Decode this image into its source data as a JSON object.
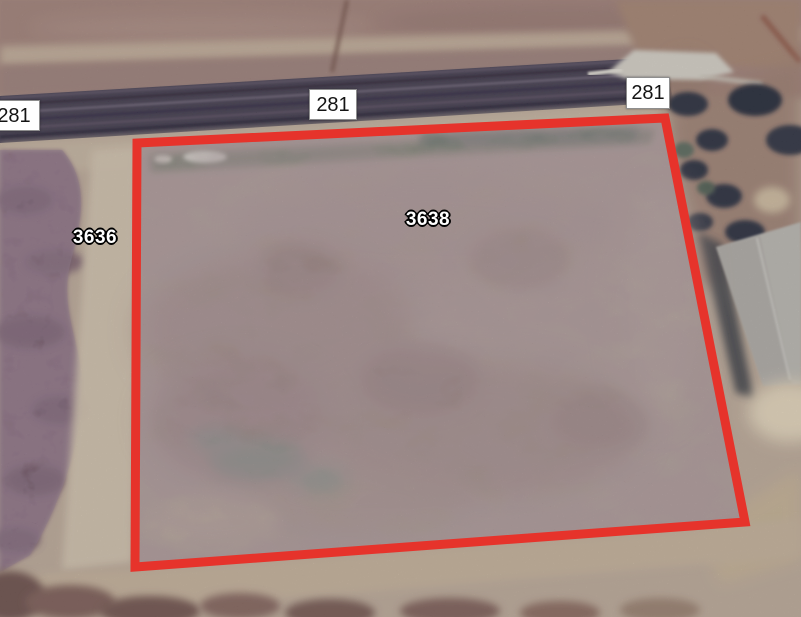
{
  "map": {
    "view": "satellite",
    "highlight_color": "#e6332b",
    "route_labels": [
      {
        "text": "281",
        "position": "left-edge"
      },
      {
        "text": "281",
        "position": "top-center"
      },
      {
        "text": "281",
        "position": "top-right"
      }
    ],
    "parcel_labels": [
      {
        "text": "3636",
        "position": "left-of-highlight"
      },
      {
        "text": "3638",
        "position": "inside-highlight"
      }
    ],
    "selected_parcel": "3638"
  }
}
